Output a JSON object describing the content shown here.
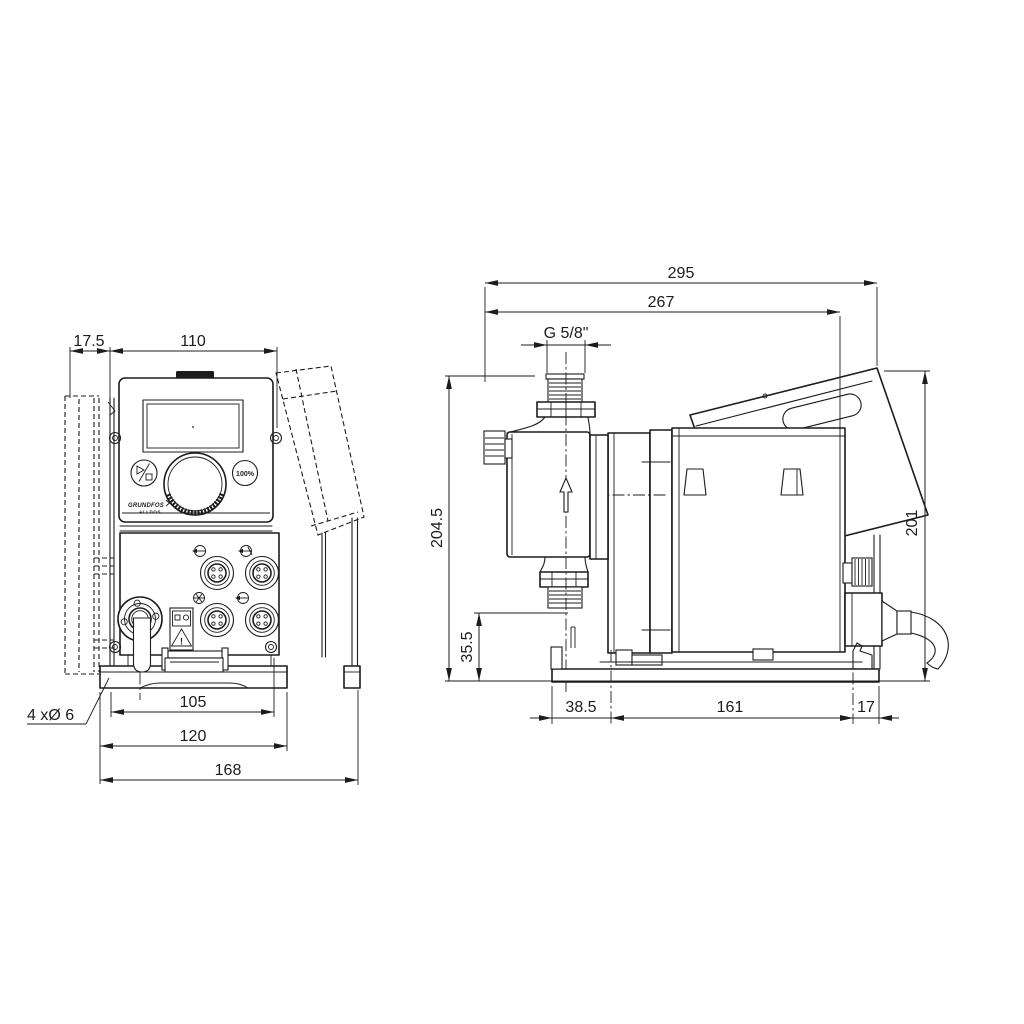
{
  "front_view": {
    "dims": {
      "plate_offset": "17.5",
      "housing_width": "110",
      "hole_pitch": "105",
      "base_width": "120",
      "overall_width": "168"
    },
    "holes_label": "4 xØ 6",
    "panel": {
      "button_100": "100%",
      "logo": "GRUNDFOS",
      "logo_sub": "ALLDOS"
    },
    "warning_mark": "!"
  },
  "side_view": {
    "dims": {
      "overall_length": "295",
      "body_length": "267",
      "connection_thread": "G 5/8\"",
      "head_height": "204.5",
      "foot_height": "35.5",
      "front_offset": "38.5",
      "mount_pitch": "161",
      "rear_offset": "17",
      "overall_height": "201"
    }
  }
}
